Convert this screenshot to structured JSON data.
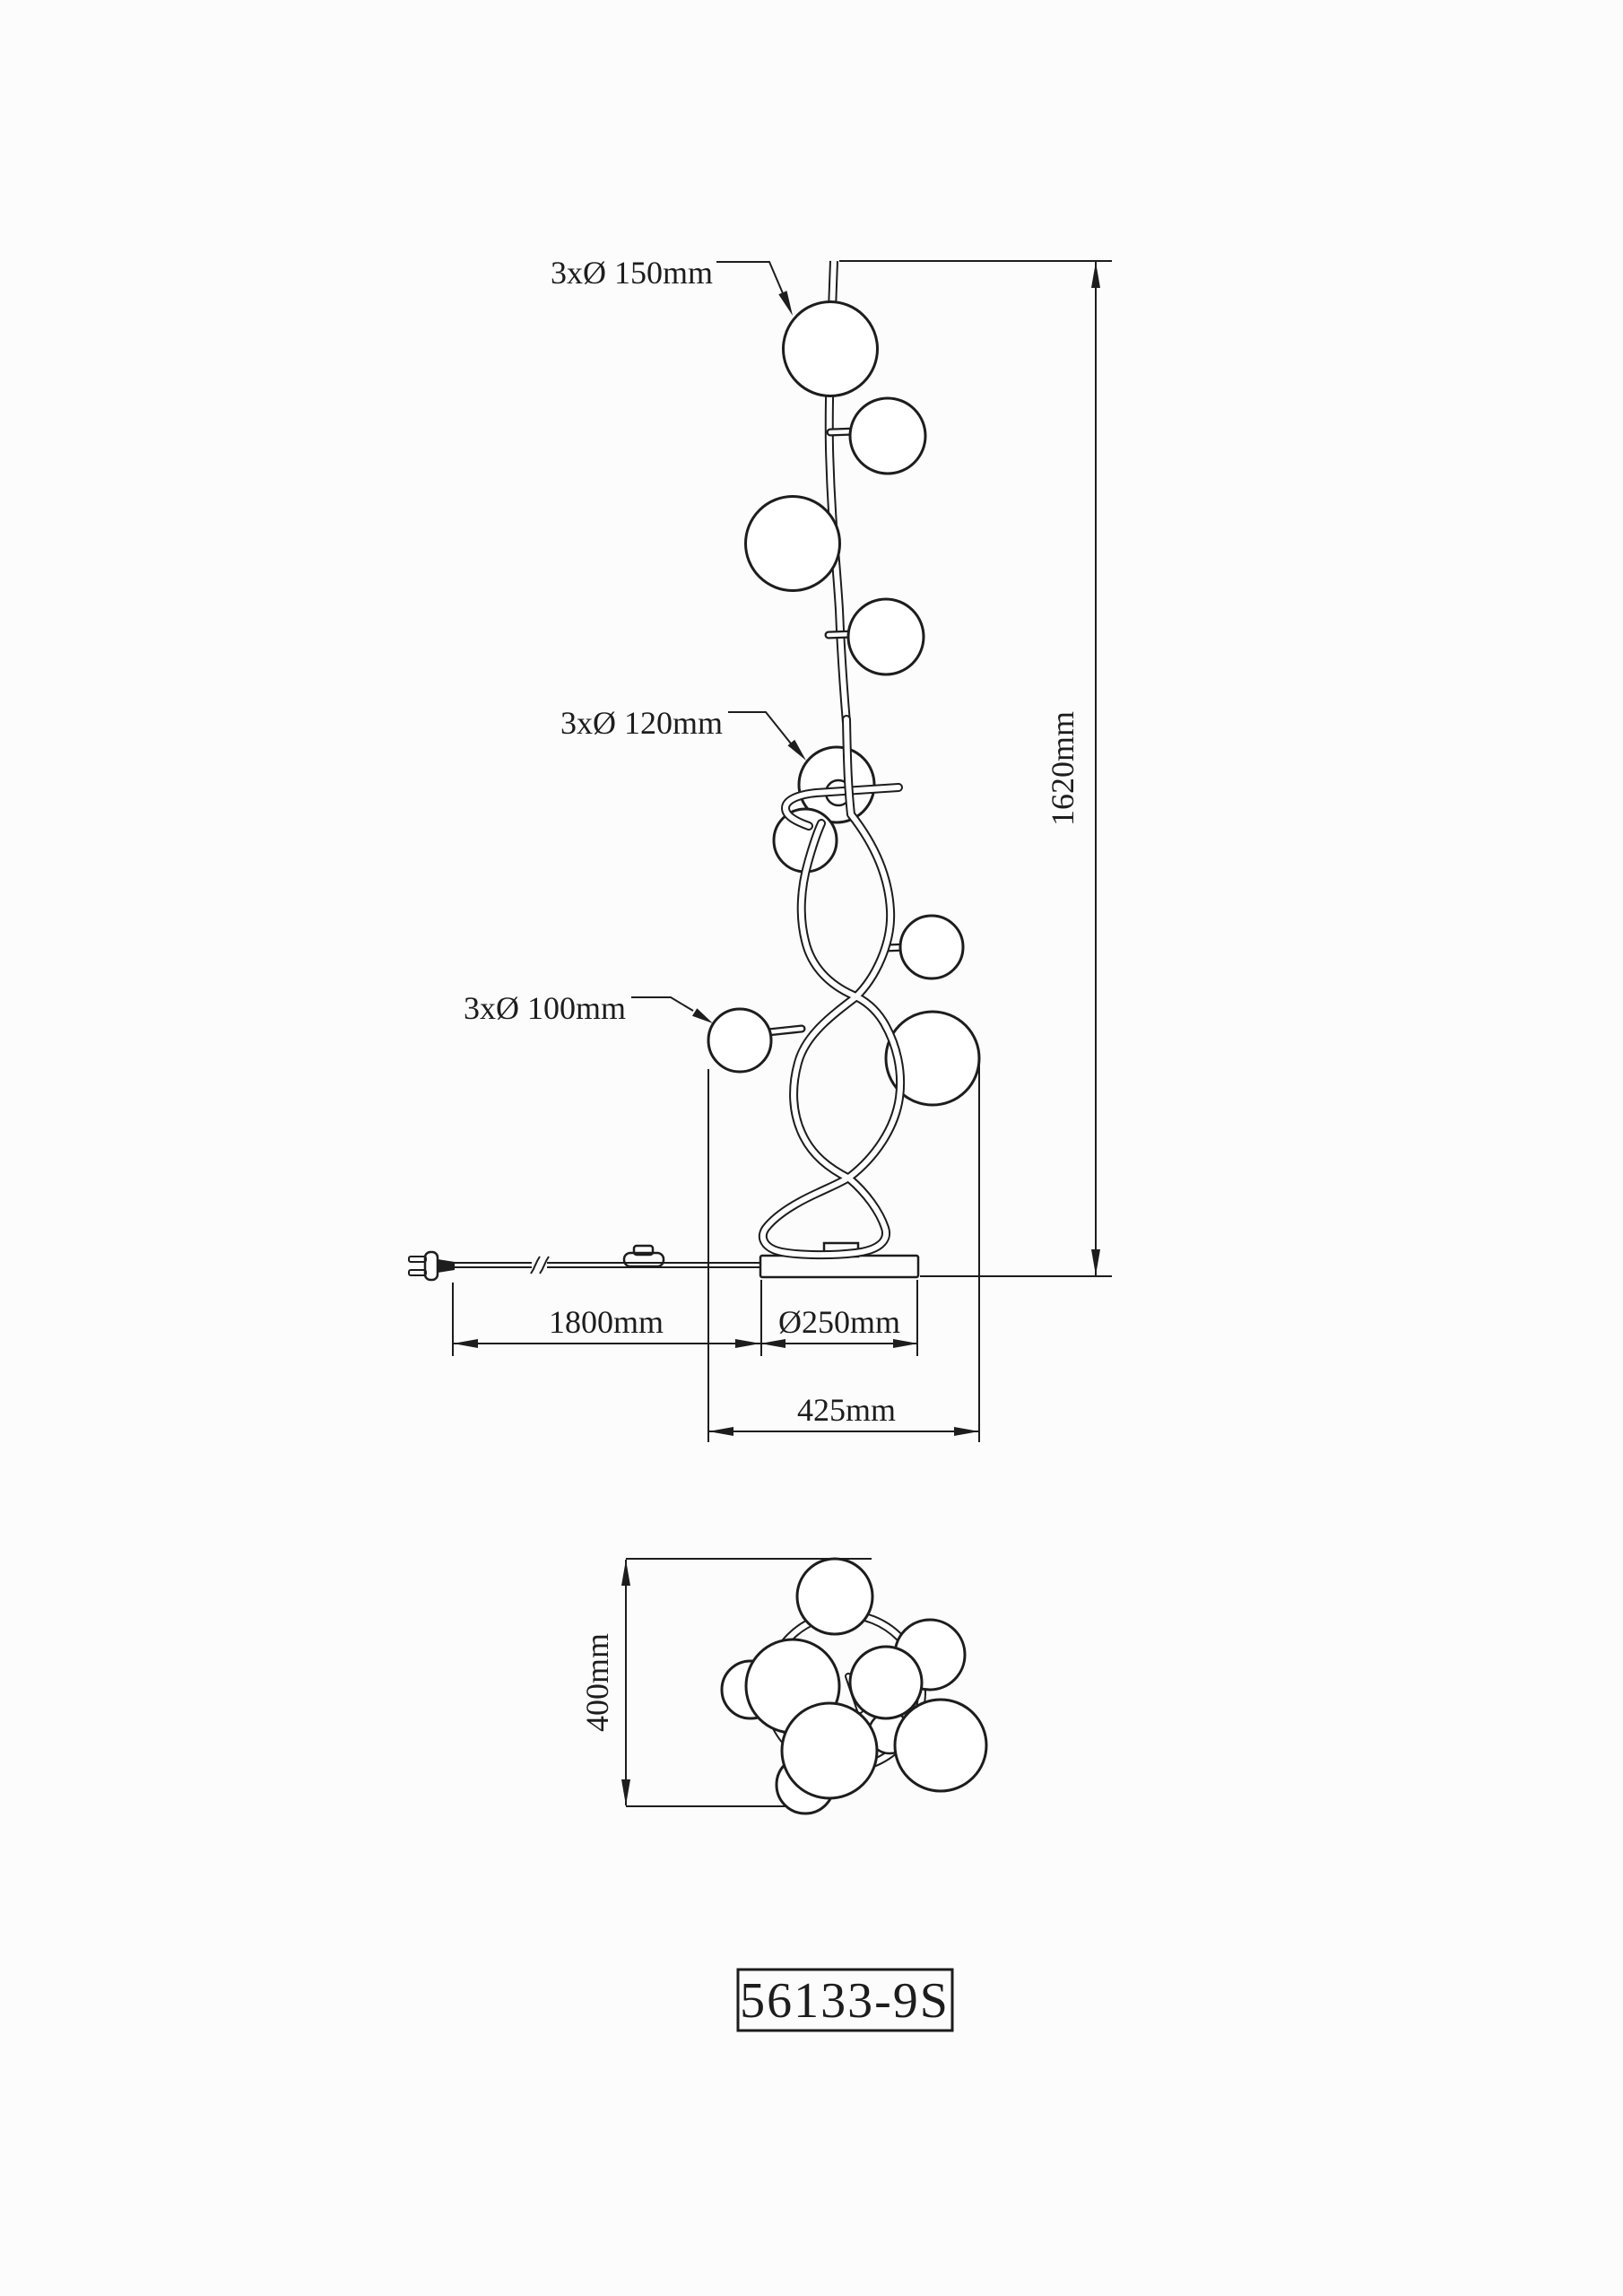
{
  "drawing_type": "lamp-dimension-diagram",
  "title_block": {
    "part_number": "56133-9S"
  },
  "front_view": {
    "leader_labels": [
      {
        "id": "globes-150",
        "text": "3xØ 150mm",
        "count": 3,
        "diameter_mm": 150
      },
      {
        "id": "globes-120",
        "text": "3xØ 120mm",
        "count": 3,
        "diameter_mm": 120
      },
      {
        "id": "globes-100",
        "text": "3xØ 100mm",
        "count": 3,
        "diameter_mm": 100
      }
    ],
    "dimensions": {
      "height_label": "1620mm",
      "height_mm": 1620,
      "cord_label": "1800mm",
      "cord_mm": 1800,
      "base_label": "Ø250mm",
      "base_diameter_mm": 250,
      "width_label": "425mm",
      "width_mm": 425
    },
    "globe_count": 9,
    "features": [
      "power-plug",
      "cord-break-marks",
      "foot-switch",
      "round-base",
      "curved-tube-stem"
    ]
  },
  "top_view": {
    "depth_label": "400mm",
    "depth_mm": 400,
    "globe_count": 9
  },
  "colors": {
    "line": "#1d1d1d",
    "background": "#fcfcfc",
    "globe_fill": "#ffffff"
  }
}
